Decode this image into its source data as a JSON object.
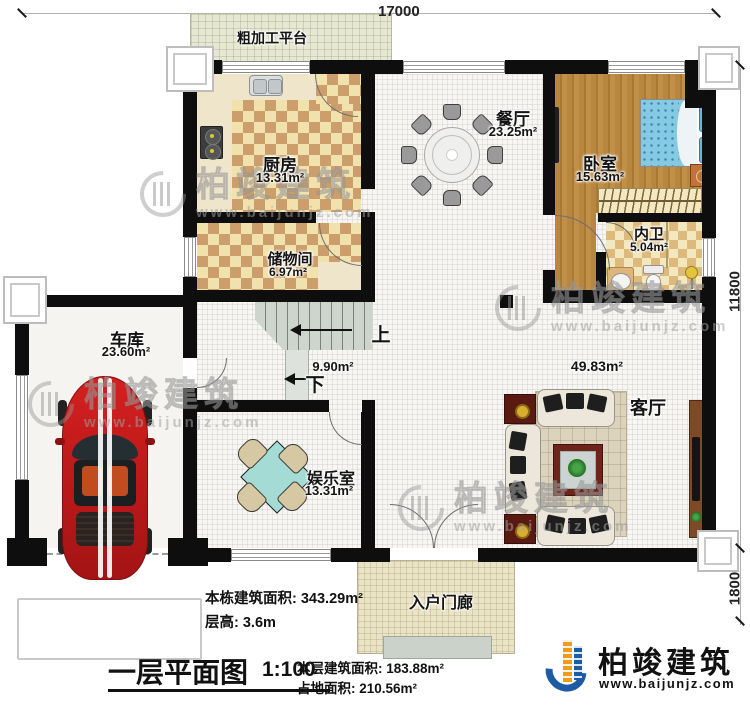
{
  "plan": {
    "dimensions": {
      "width_total": "17000",
      "height_main": "11800",
      "height_porch": "1800"
    },
    "rooms": {
      "platform": {
        "name": "粗加工平台"
      },
      "kitchen": {
        "name": "厨房",
        "area": "13.31m²"
      },
      "storage": {
        "name": "储物间",
        "area": "6.97m²"
      },
      "dining": {
        "name": "餐厅",
        "area": "23.25m²"
      },
      "bedroom": {
        "name": "卧室",
        "area": "15.63m²"
      },
      "bathroom": {
        "name": "内卫",
        "area": "5.04m²"
      },
      "garage": {
        "name": "车库",
        "area": "23.60m²"
      },
      "entertainment": {
        "name": "娱乐室",
        "area": "13.31m²"
      },
      "living": {
        "name": "客厅",
        "area": "49.83m²"
      },
      "stairs": {
        "area": "9.90m²",
        "up": "上",
        "down": "下"
      },
      "porch": {
        "name": "入户门廊"
      }
    }
  },
  "title_block": {
    "building_total_area": "本栋建筑面积: 343.29m²",
    "floor_height": "层高: 3.6m",
    "plan_title": "一层平面图",
    "scale": "1:100",
    "floor_area": "本层建筑面积: 183.88m²",
    "footprint_area": "占地面积: 210.56m²"
  },
  "branding": {
    "logo_text": "柏竣建筑",
    "logo_url": "www.baijunjz.com",
    "watermark_text": "柏竣建筑",
    "watermark_url": "www.baijunjz.com"
  },
  "colors": {
    "wall": "#0e0e0e",
    "wood_floor": "#b8873f",
    "tile_dark": "#cb9e6b",
    "tile_light": "#f1e2ad",
    "bed_blue": "#85cae2",
    "car_red": "#c81e1e",
    "logo_blue": "#1d5ca5",
    "logo_orange": "#ef9c1c"
  }
}
